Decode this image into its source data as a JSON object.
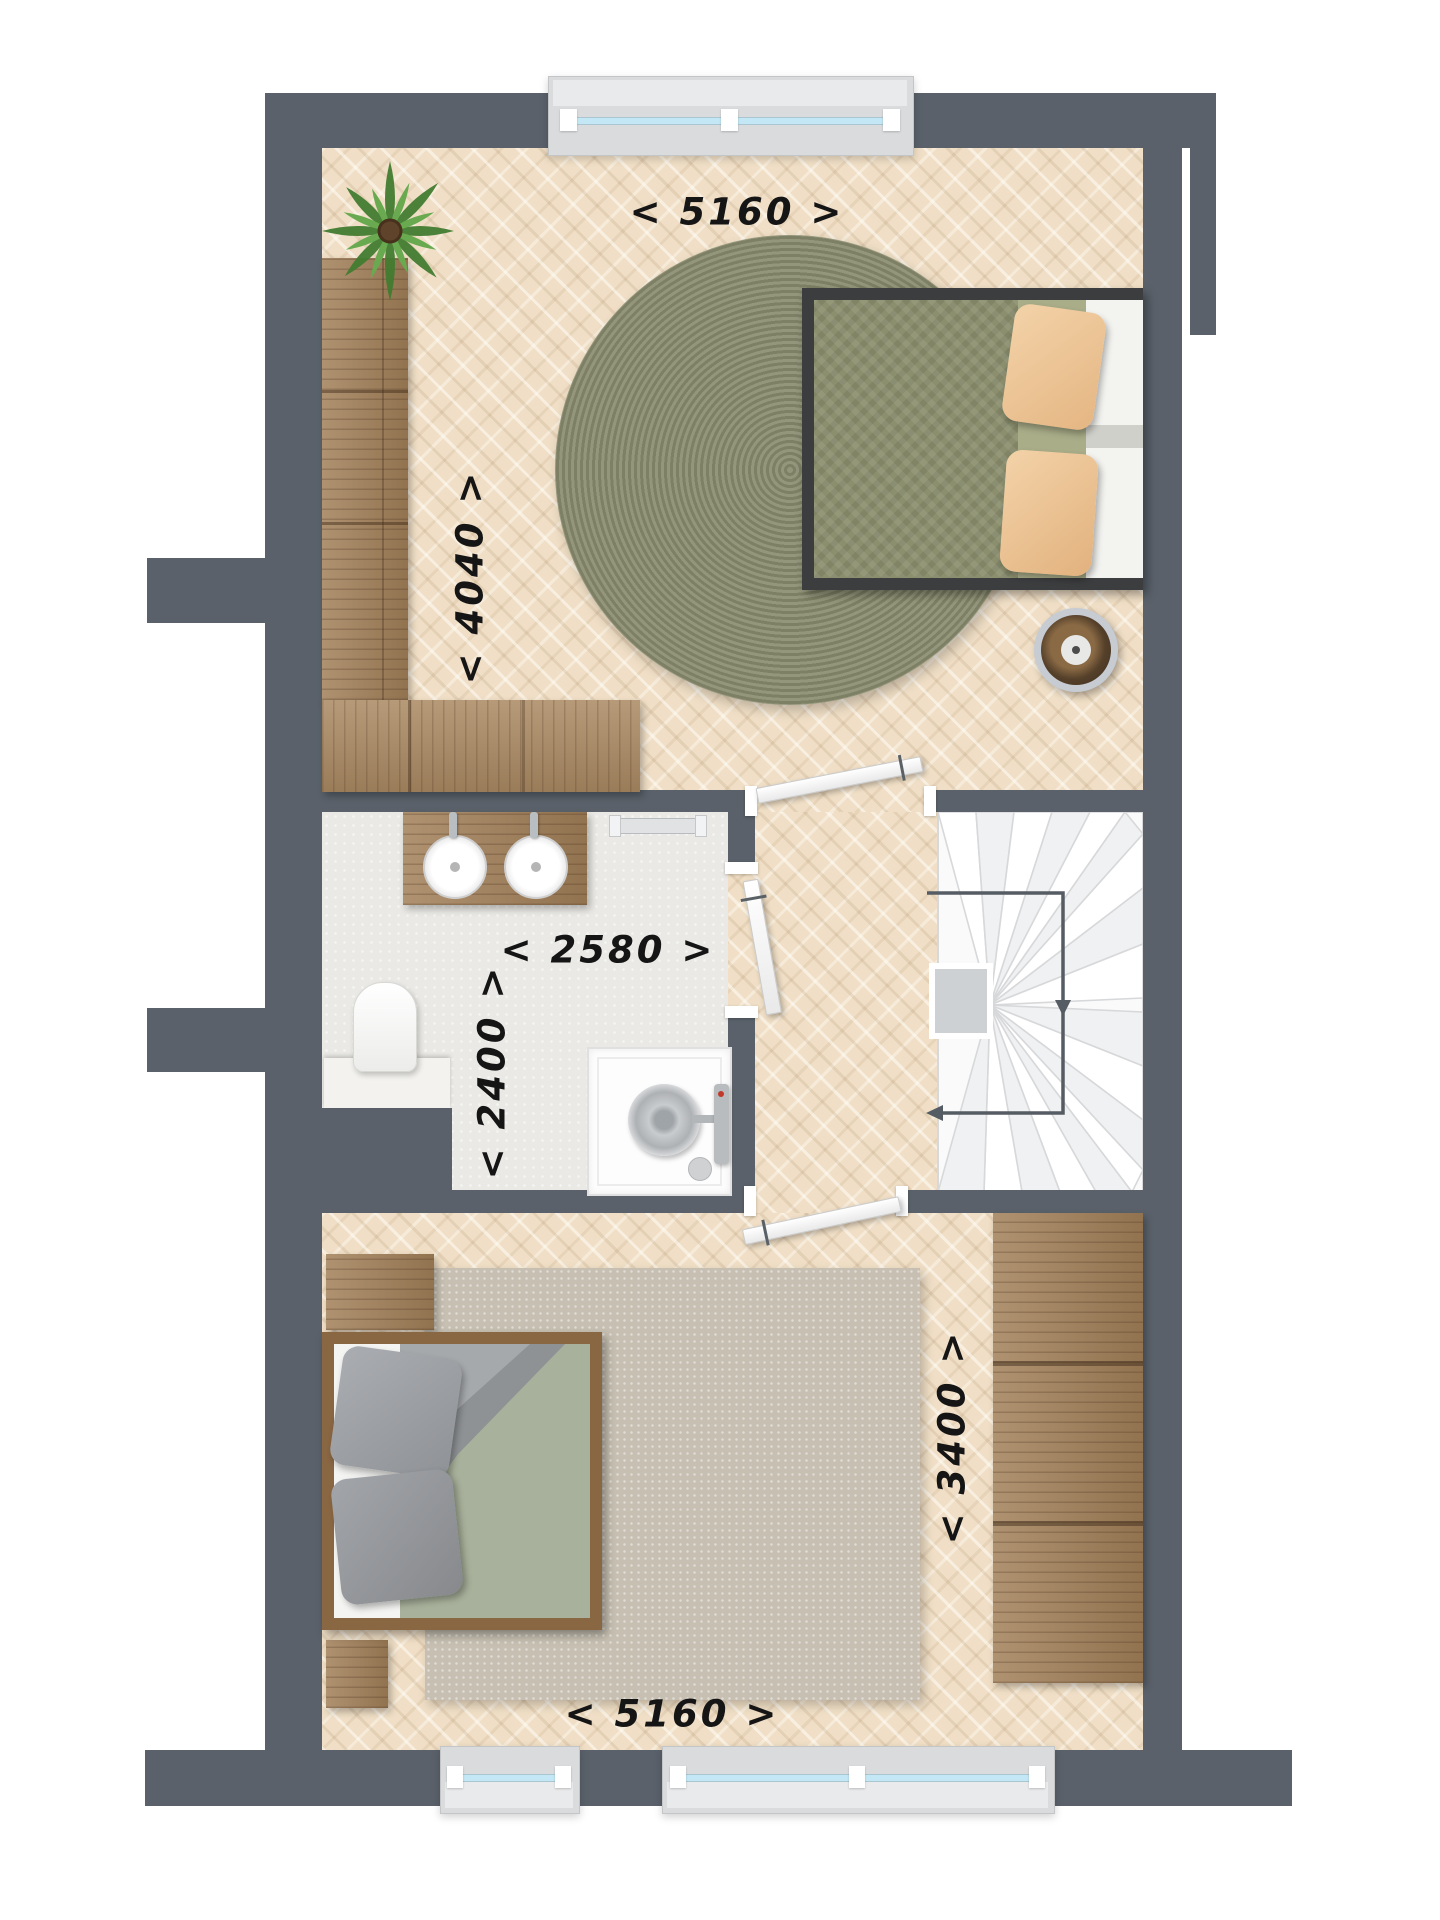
{
  "floorplan": {
    "canvas": {
      "width_px": 1440,
      "height_px": 1920
    },
    "labels": {
      "bedroom_top_width": {
        "text": "< 5160 >",
        "orientation": "horizontal"
      },
      "bedroom_top_depth": {
        "text": "< 4040 >",
        "orientation": "vertical"
      },
      "bathroom_width": {
        "text": "< 2580 >",
        "orientation": "horizontal"
      },
      "bathroom_depth": {
        "text": "< 2400 >",
        "orientation": "vertical"
      },
      "bedroom_bottom_depth": {
        "text": "< 3400 >",
        "orientation": "vertical"
      },
      "bedroom_bottom_width": {
        "text": "< 5160 >",
        "orientation": "horizontal"
      }
    },
    "colors": {
      "wall": "#5a616a",
      "parquet_floor": "#f0dfc6",
      "bathroom_floor": "#eae9e5",
      "stair_tread": "#fafafa",
      "window_glass": "#c3e7f4",
      "window_frame": "#d9dbdd",
      "duvet_green_patterned": "#8b8f6e",
      "duvet_sage": "#a8b19b",
      "pillow_peach": "#eec59a",
      "round_rug": "#8e9077",
      "area_rug": "#c7c0b2",
      "furniture_wood": "#a28059",
      "direction_arrow": "#565c63"
    },
    "rooms": [
      {
        "name": "bedroom-top",
        "floor": "parquet",
        "furniture": [
          "corner-wardrobe",
          "plant",
          "round-rug",
          "double-bed",
          "pouf"
        ]
      },
      {
        "name": "bathroom",
        "floor": "tile",
        "furniture": [
          "double-washbasin-vanity",
          "towel-rail",
          "toilet",
          "shower"
        ]
      },
      {
        "name": "landing",
        "floor": "parquet",
        "furniture": [
          "winder-staircase"
        ]
      },
      {
        "name": "bedroom-bottom",
        "floor": "parquet",
        "furniture": [
          "double-bed",
          "nightstand",
          "nightstand",
          "area-rug",
          "wardrobe"
        ]
      }
    ],
    "windows": {
      "top_wall": 1,
      "bottom_wall": 2
    },
    "doors": 3,
    "stairs": {
      "direction_arrow": "down-and-left"
    }
  }
}
